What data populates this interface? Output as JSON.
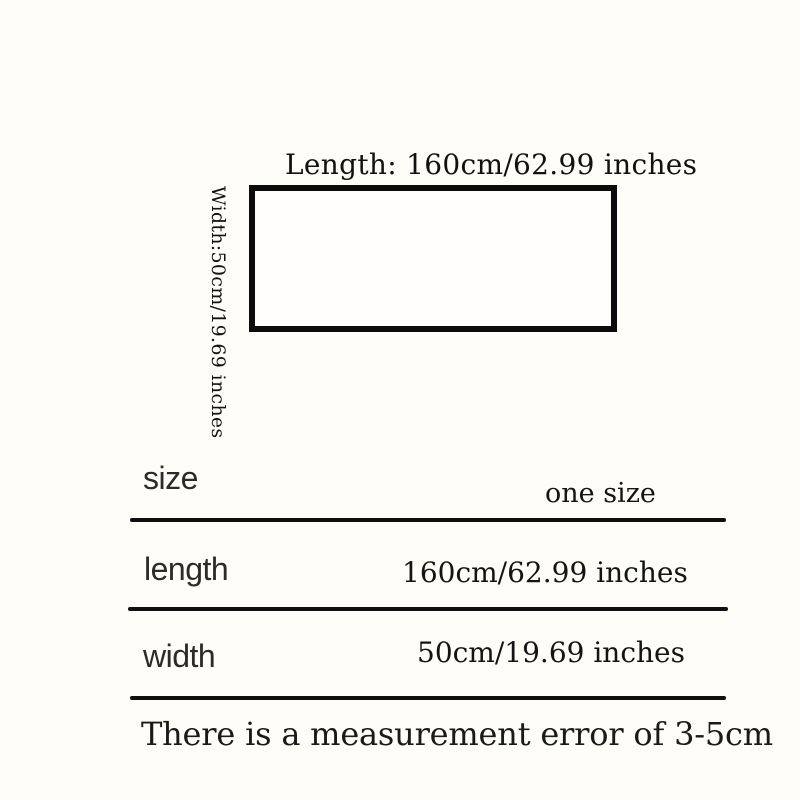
{
  "diagram": {
    "length_label": "Length: 160cm/62.99 inches",
    "width_label": "Width:50cm/19.69 inches"
  },
  "size_table": {
    "rows": [
      {
        "label": "size",
        "value": "one size"
      },
      {
        "label": "length",
        "value": "160cm/62.99 inches"
      },
      {
        "label": "width",
        "value": "50cm/19.69 inches"
      }
    ],
    "note": "There is a measurement error of 3-5cm"
  },
  "colors": {
    "background": "#fffdf7",
    "ink": "#111111"
  }
}
